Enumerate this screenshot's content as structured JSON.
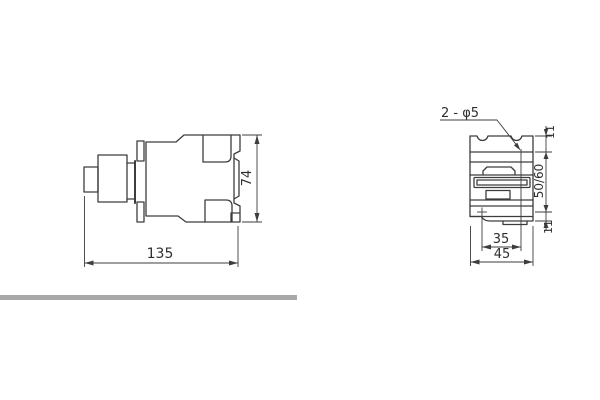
{
  "colors": {
    "line": "#3d3d3d",
    "text": "#2f2f2f",
    "divider": "#a8a8a8",
    "background": "#ffffff"
  },
  "side_view": {
    "dim_width": "135",
    "dim_height": "74"
  },
  "front_view": {
    "hole_callout": "2 - φ5",
    "dim_hole_spacing": "35",
    "dim_width": "45",
    "dim_rail": "50/60",
    "dim_top": "11",
    "dim_bottom": "11"
  }
}
